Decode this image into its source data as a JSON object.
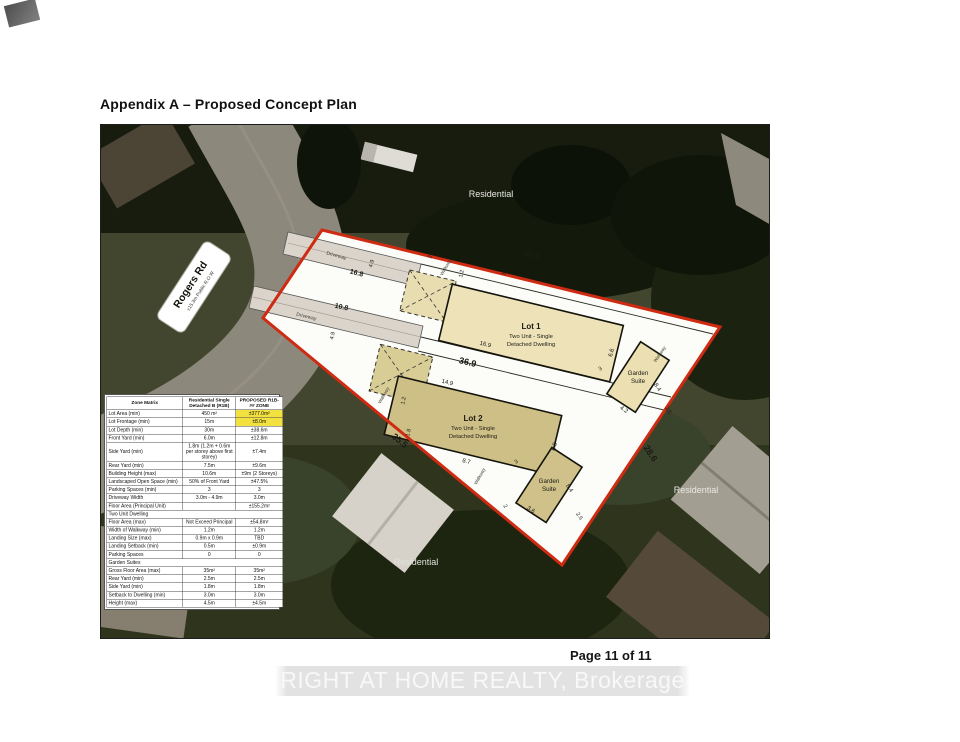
{
  "page": {
    "title": "Appendix A – Proposed Concept Plan",
    "page_number": "Page 11 of 11",
    "watermark": "RIGHT AT HOME REALTY, Brokerage"
  },
  "plan": {
    "road": {
      "name": "Rogers Rd",
      "row": "±15.3m Public R.O.W"
    },
    "residential_label": "Residential",
    "driveway_label": "Driveway",
    "walkway_label": "Walkway",
    "lot1": {
      "title": "Lot 1",
      "line1": "Two Unit - Single",
      "line2": "Detached Dwelling"
    },
    "lot2": {
      "title": "Lot 2",
      "line1": "Two Unit - Single",
      "line2": "Detached Dwelling"
    },
    "garden_suite": {
      "line1": "Garden",
      "line2": "Suite"
    },
    "dims": {
      "top": "40.9",
      "mid": "36.9",
      "southwest": "35.5",
      "east": "28.6",
      "drive1": "16.8",
      "drive2": "10.8",
      "lot1_front": "16.9",
      "lot2_front": "14.9",
      "lot2_side": "8.7",
      "lot1_side": "6.6",
      "lot2_depth": "6.8",
      "suite_long": "8.4",
      "suite_short": "4.2",
      "suite_setback": "2.5",
      "suite_gap": "3",
      "suite_rear": "3.6",
      "walk_gap": "2.6",
      "walk_width": "1.2",
      "landing": "1.8",
      "drive_width": "4.9",
      "rear_gap": "2"
    }
  },
  "zone_matrix": {
    "title": "Zone Matrix",
    "col_r1b": "Residential Single Detached B (R1B)",
    "col_proposed": "PROPOSED R1B-## ZONE",
    "rows": [
      {
        "label": "Lot Area (min)",
        "r1b": "450 m²",
        "proposed": "±377.0m²",
        "highlight": true
      },
      {
        "label": "Lot Frontage (min)",
        "r1b": "15m",
        "proposed": "±8.0m",
        "highlight": true
      },
      {
        "label": "Lot Depth (min)",
        "r1b": "30m",
        "proposed": "±38.6m"
      },
      {
        "label": "Front Yard (min)",
        "r1b": "6.0m",
        "proposed": "±12.8m"
      },
      {
        "label": "Side Yard (min)",
        "r1b": "1.8m (1.2m + 0.6m per storey above first storey)",
        "proposed": "±7.4m"
      },
      {
        "label": "Rear Yard (min)",
        "r1b": "7.5m",
        "proposed": "±9.6m"
      },
      {
        "label": "Building Height (max)",
        "r1b": "10.6m",
        "proposed": "±9m (2 Storeys)"
      },
      {
        "label": "Landscaped Open Space (min)",
        "r1b": "50% of Front Yard",
        "proposed": "±47.5%"
      },
      {
        "label": "Parking Spaces (min)",
        "r1b": "3",
        "proposed": "3"
      },
      {
        "label": "Driveway Width",
        "r1b": "3.0m - 4.9m",
        "proposed": "3.0m"
      },
      {
        "label": "Floor Area (Principal Unit)",
        "r1b": "",
        "proposed": "±155.2m²"
      },
      {
        "label": "Two Unit Dwelling",
        "section": true
      },
      {
        "label": "Floor Area (max)",
        "r1b": "Not Exceed Principal",
        "proposed": "±54.8m²"
      },
      {
        "label": "Width of Walkway (min)",
        "r1b": "1.2m",
        "proposed": "1.2m"
      },
      {
        "label": "Landing Size (max)",
        "r1b": "0.9m x 0.9m",
        "proposed": "TBD"
      },
      {
        "label": "Landing Setback (min)",
        "r1b": "0.5m",
        "proposed": "±0.9m"
      },
      {
        "label": "Parking Spaces",
        "r1b": "0",
        "proposed": "0"
      },
      {
        "label": "Garden Suites",
        "section": true
      },
      {
        "label": "Gross Floor Area (max)",
        "r1b": "35m²",
        "proposed": "35m²"
      },
      {
        "label": "Rear Yard (min)",
        "r1b": "2.5m",
        "proposed": "2.5m"
      },
      {
        "label": "Side Yard (min)",
        "r1b": "1.8m",
        "proposed": "1.8m"
      },
      {
        "label": "Setback to Dwelling (min)",
        "r1b": "3.0m",
        "proposed": "3.0m"
      },
      {
        "label": "Height (max)",
        "r1b": "4.5m",
        "proposed": "±4.5m"
      }
    ]
  }
}
